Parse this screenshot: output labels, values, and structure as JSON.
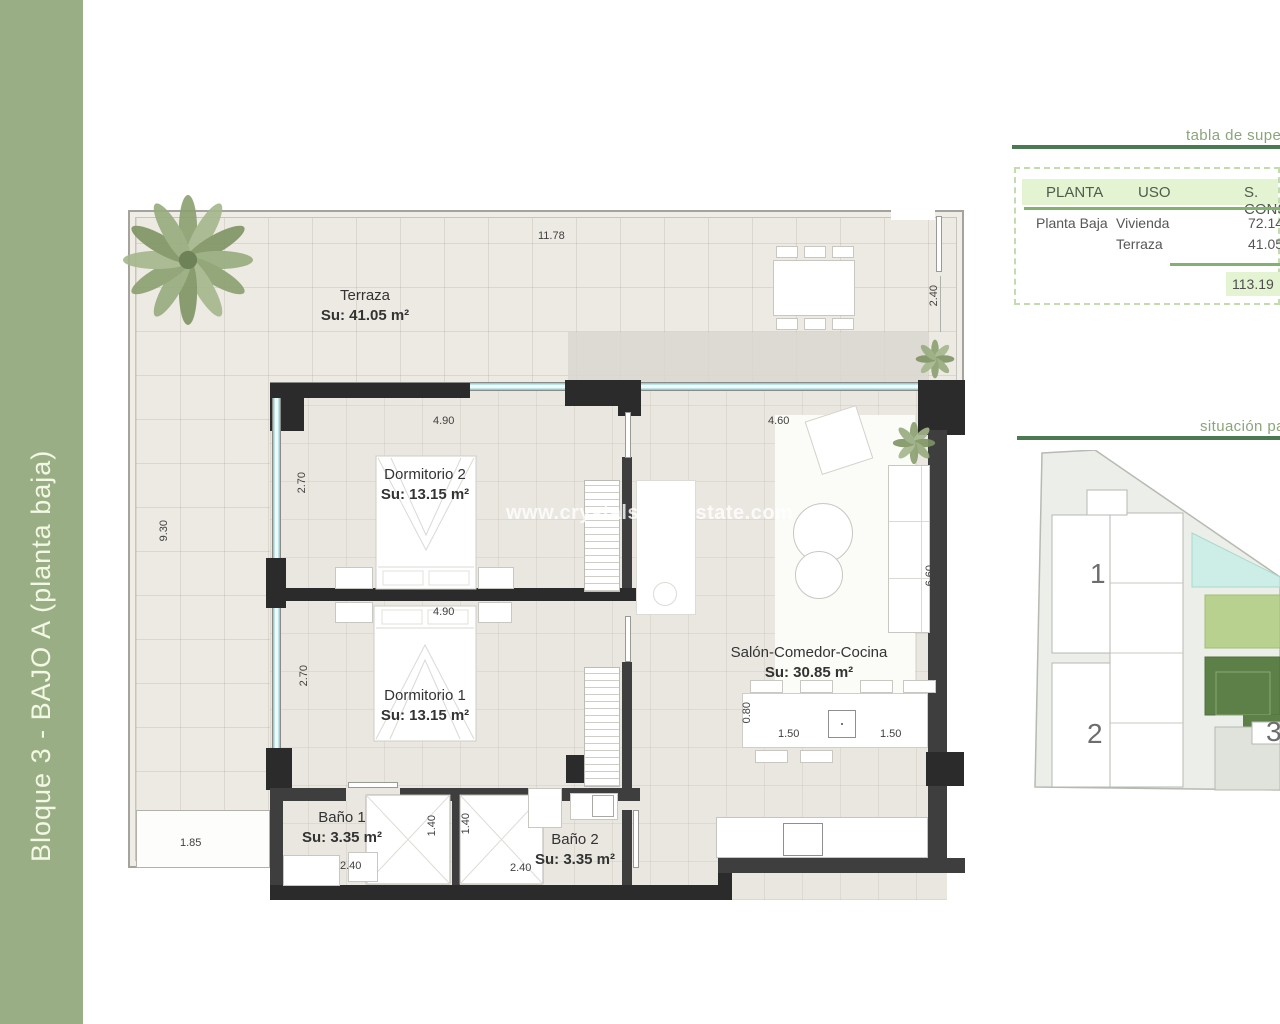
{
  "side_band": {
    "label": "Bloque 3 - BAJO A (planta baja)"
  },
  "watermark": "www.crystals-realestate.com",
  "plan": {
    "rooms": {
      "terraza": {
        "name": "Terraza",
        "area": "Su: 41.05 m²"
      },
      "dorm2": {
        "name": "Dormitorio 2",
        "area": "Su: 13.15 m²"
      },
      "dorm1": {
        "name": "Dormitorio 1",
        "area": "Su: 13.15 m²"
      },
      "bano1": {
        "name": "Baño 1",
        "area": "Su: 3.35 m²"
      },
      "bano2": {
        "name": "Baño 2",
        "area": "Su: 3.35 m²"
      },
      "salon": {
        "name": "Salón-Comedor-Cocina",
        "area": "Su: 30.85 m²"
      }
    },
    "dims": {
      "top_width": "11.78",
      "terrace_gate": "2.40",
      "terrace_left": "9.30",
      "planter": "1.85",
      "dorm2_w": "4.90",
      "dorm2_d": "2.70",
      "dorm1_w": "4.90",
      "dorm1_d": "2.70",
      "salon_w": "4.60",
      "salon_d": "6.60",
      "shower1": "1.40",
      "shower2": "1.40",
      "bano1_w": "2.40",
      "bano2_w": "2.40",
      "island_d": "0.80",
      "island_l": "1.50",
      "island_r": "1.50"
    }
  },
  "surface_table": {
    "title": "tabla de supe",
    "col_planta": "PLANTA",
    "col_uso": "USO",
    "col_sup": "S. CONS",
    "rows": [
      {
        "planta": "Planta Baja",
        "uso": "Vivienda",
        "sup": "72.14"
      },
      {
        "planta": "",
        "uso": "Terraza",
        "sup": "41.05"
      }
    ],
    "total": "113.19"
  },
  "site_plan": {
    "title": "situación pa",
    "b1": "1",
    "b2": "2",
    "b3": "3"
  },
  "colors": {
    "band_green": "#9aae85",
    "accent_green": "#4b7a52",
    "table_green": "#e4f3d1",
    "site_dark_green": "#5d8049",
    "site_light_green": "#b9d18f",
    "pool_cyan": "#cdeee7",
    "glazing_cyan": "#8fd2d6"
  }
}
